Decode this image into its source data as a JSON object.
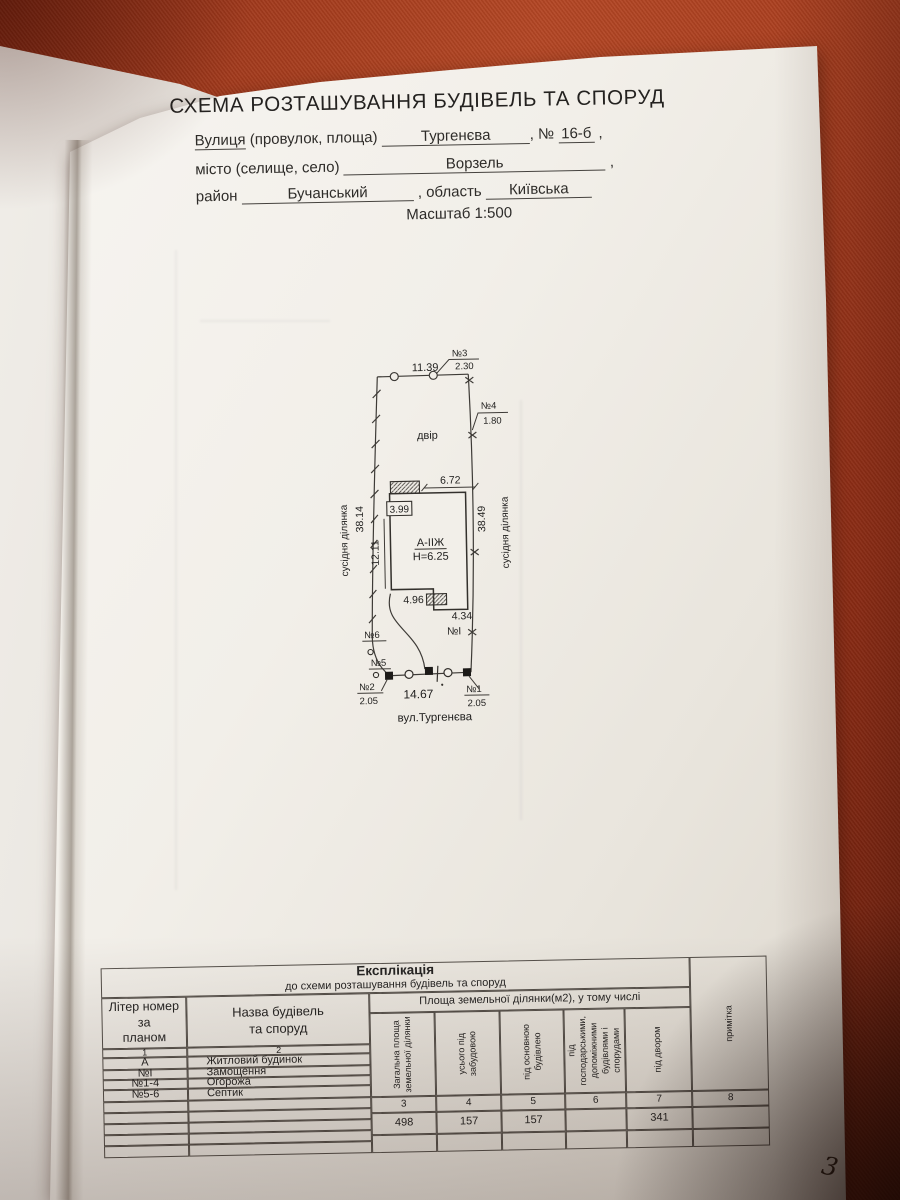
{
  "page_number": "3",
  "header": {
    "title": "СХЕМА РОЗТАШУВАННЯ БУДІВЕЛЬ ТА СПОРУД",
    "street_label_word": "Вулиця",
    "street_label_rest": " (провулок, площа)",
    "street_value": "Тургенєва",
    "number_prefix": ", №",
    "number_value": "16-б",
    "trailing_comma": ",",
    "city_label": "місто (селище, село)",
    "city_value": "Ворзель",
    "district_label": "район",
    "district_value": "Бучанський",
    "region_label": ", область",
    "region_value": "Київська",
    "scale": "Масштаб  1:500"
  },
  "plan": {
    "yard_label": "двір",
    "building_label": "А-ІІЖ",
    "building_height": "Н=6.25",
    "paving_label": "№I",
    "street": "вул.Тургенєва",
    "neighbor_left": "сусідня ділянка",
    "neighbor_right": "сусідня ділянка",
    "dims": {
      "top": "11.39",
      "left_boundary": "38.14",
      "right_boundary": "38.49",
      "building_top": "6.72",
      "annex": "3.99",
      "building_left": "12.11",
      "bottom_left_wing": "4.96",
      "bottom_right_wing": "4.34",
      "bottom": "14.67"
    },
    "markers": {
      "n1": "№1",
      "n1_size": "2.05",
      "n2": "№2",
      "n2_size": "2.05",
      "n3": "№3",
      "n3_size": "2.30",
      "n4": "№4",
      "n4_size": "1.80",
      "n5": "№5",
      "n6": "№6"
    }
  },
  "table": {
    "title": "Експлікація",
    "subtitle": "до схеми розташування будівель та споруд",
    "col1_header": "Літер номер\nза\nпланом",
    "col2_header": "Назва будівель\nта споруд",
    "area_header": "Площа земельної ділянки(м2), у тому числі",
    "vcols": [
      "Загальна площа\nземельної ділянки",
      "усього під\nзабудовою",
      "під основною\nбудівлею",
      "під\nгосподарськими,\nдопоміжними\nбудівлями і\nспорудами",
      "під  двором",
      "примітка"
    ],
    "col_numbers": [
      "1",
      "2",
      "3",
      "4",
      "5",
      "6",
      "7",
      "8"
    ],
    "rows": [
      {
        "liter": "А",
        "name": "Житловий будинок"
      },
      {
        "liter": "№I",
        "name": "Замощення"
      },
      {
        "liter": "№1-4",
        "name": "Огорожа"
      },
      {
        "liter": "№5-6",
        "name": "Септик"
      }
    ],
    "values": [
      "498",
      "157",
      "157",
      "",
      "341",
      ""
    ]
  }
}
